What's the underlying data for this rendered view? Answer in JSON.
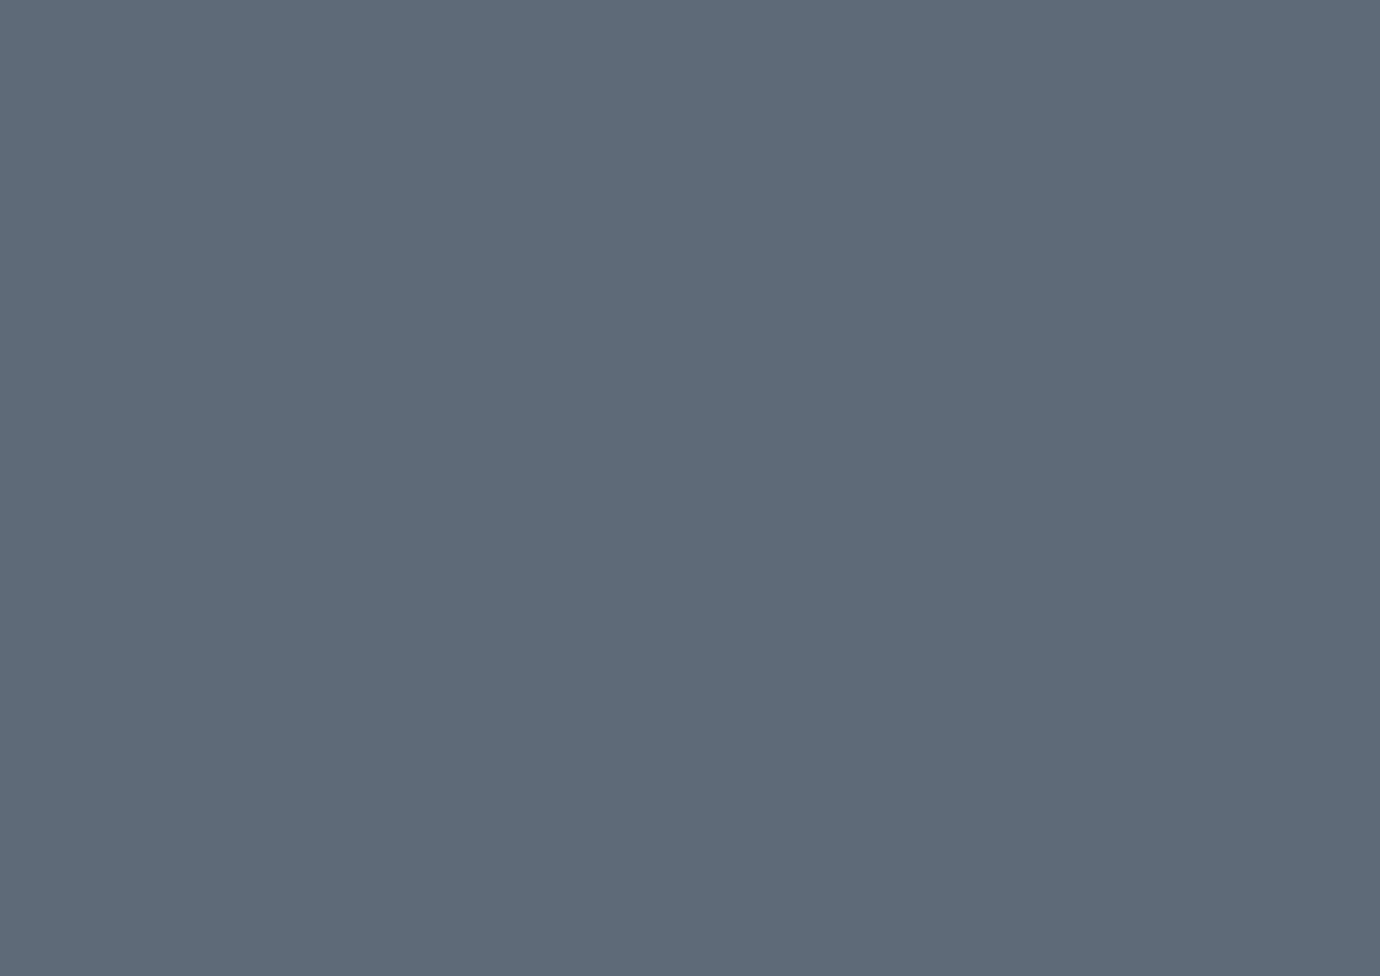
{
  "meta": {
    "title": "Golden oval stadium — aerial concept rendering",
    "type": "3D architectural visualization, bird's-eye view",
    "time_of_day": "afternoon sun blooming from the upper right",
    "description": "Aerial daytime rendering of an oval stadium with a white radially pleated membrane roof ringed by an olive-green band with a tan stripe, over a golden facade decorated with teal, green and gold circular medallions. The roof opening, haloed by a translucent golden lattice ring, reveals dark crowded stands with sunlit golden seating on the west side, glowing floodlights and a striped green football pitch with white markings. The stadium stands on a blue-grey plaza dotted with white conical shade umbrellas, square reflecting pools, lawn circles, palm trees, red banners and crowds of tiny figures. A sandy low-rise neighbourhood with palm-lined streets fills the upper left, diagonal rows of white coaches and car parking stretch across the hazy sunlit upper right, and palm-lined boulevards with dashed lane markings run through the lower right corner."
  },
  "scene": {
    "stadium": {
      "roof": "white radial pleated membrane, 64 ribs",
      "roof_rim": "olive green band, tan stripe, dark grey on the sunlit edge",
      "skylight": "golden diagrid lattice ring over the stands",
      "facade": "golden screen with teal, green and gold circular medallions and slatted colonnade",
      "bowl": "dark stands full of spectators, golden sunlit seating block",
      "pitch": "mowing-striped green football pitch, white markings, ad boards",
      "floodlights": 16
    },
    "plaza": {
      "umbrellas": "white conical fabric canopies on single masts",
      "umbrella_count": 41,
      "reflecting_pools": 13,
      "lawn_circles": 10,
      "red_banners": 9,
      "crowd_clusters": 24,
      "kiosks": 4
    },
    "surroundings": {
      "neighborhood": "cream low-rise housing blocks, upper left",
      "building_count": 24,
      "bus_parking": "diagonal rows of white coaches, upper middle",
      "bus_count": 51,
      "car_parking": "upper-right corner, shaded east lots, south lots with trucks",
      "boulevard": "palm-lined dual carriageway with dashed lanes, lower right",
      "palm_count": 120,
      "trucks": 5
    }
  },
  "counts": {
    "roof_ribs": 64,
    "lattice_spokes": 40,
    "pitch_stripes": 11
  },
  "colors": {
    "bgTop": "#c2cbd2",
    "bgMid": "#8d97a3",
    "bgBottom": "#5d6876",
    "paving": "#ffffff",
    "shadow": "#1c2736",
    "warmLight": "#e8d9b0",
    "roofHigh": "#ffffff",
    "roofMid": "#eef1f4",
    "roofLow": "#aeb7c1",
    "ribDark": "#8e98a3",
    "ribLight": "#ffffff",
    "rimOlive": "#a6b17b",
    "rimTan": "#d8ad64",
    "rimDark": "#555b63",
    "facade1": "#8a7a55",
    "facade2": "#c89a52",
    "facade3": "#ef9d42",
    "facade4": "#fbd28c",
    "slat": "#8a6a38",
    "medTeal": "#74b49e",
    "medGreen": "#9cc06c",
    "medGold": "#dab558",
    "latticeFill": "#c9b273",
    "latticeLine": "#6d6747",
    "bowlDark": "#262019",
    "standsBase": "#4a4034",
    "standsGold": "#c59a55",
    "apron": "#38322b",
    "pitchA": "#4c8234",
    "pitchB": "#3f7029",
    "pitchLine": "#dfe9d8",
    "poolHi": "#c3d6e8",
    "poolMid": "#8fb0d0",
    "poolLo": "#5a7fae",
    "poolEdge": "#d8dee5",
    "lawn": "#5f9140",
    "palmDark": "#3f7a2e",
    "palmLight": "#62a03c",
    "sand": "#e9e4d0",
    "bldgTop": "#f4edd8",
    "bldgSide": "#cfc5a4",
    "bldgShadow": "#9aa3a8",
    "roadGray": "#9aa1a8",
    "lane": "#eceff1",
    "asphalt": "#6b7179",
    "asphaltLane": "#5d636b",
    "road": "#79808a",
    "median": "#5e8a41",
    "bus": "#edf0f2",
    "busLine": "#aeb6bd",
    "tent": "#eef1f3",
    "carWhite": "#e9ebee",
    "carSilver": "#c0c6cc",
    "carRed": "#a63a30",
    "carBlue": "#33507b",
    "carDark": "#2c3137",
    "bannerRed": "#c23b30",
    "pole": "#9aa2ab",
    "p1": "#20262e",
    "p2": "#b03328",
    "p3": "#2d4d7c",
    "p4": "#e8e4da",
    "glint": "#ffffff"
  }
}
